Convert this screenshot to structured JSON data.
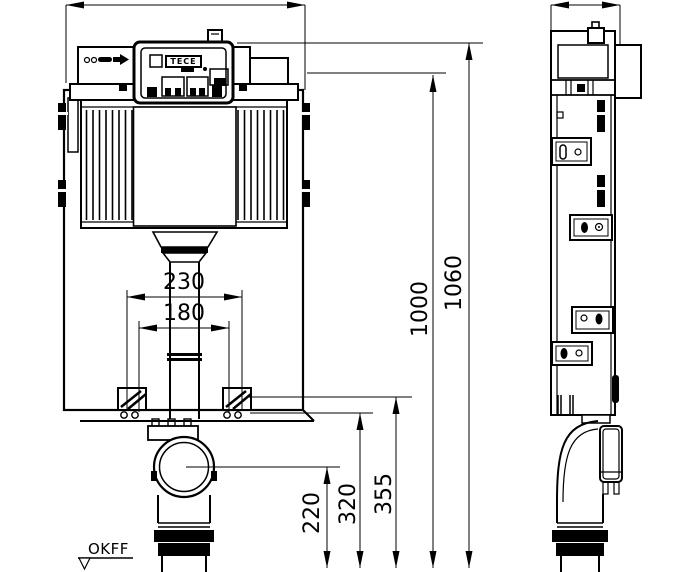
{
  "brand": {
    "logo": "TECE"
  },
  "floor_datum": {
    "label": "OKFF"
  },
  "dimensions": {
    "bolt_spacing": "230",
    "drain_spacing": "180",
    "drain_center_height": "220",
    "frame_bottom_height": "320",
    "bracket_height": "355",
    "frame_height": "1000",
    "total_height": "1060"
  },
  "colors": {
    "line": "#000000",
    "background": "#ffffff"
  }
}
